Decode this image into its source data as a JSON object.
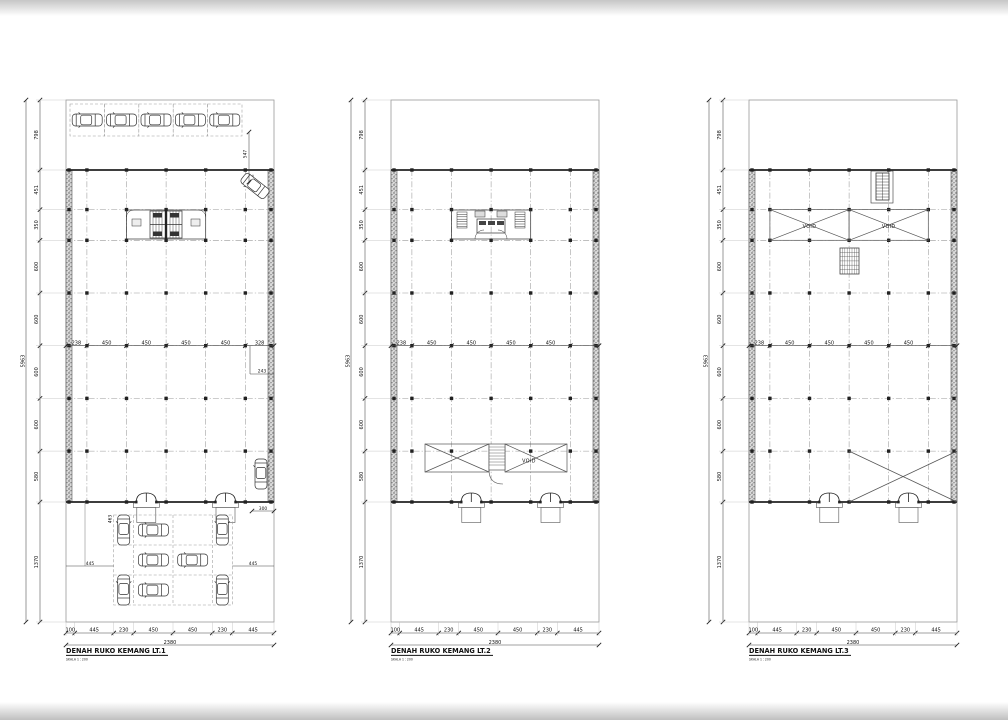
{
  "sheet": {
    "plans": [
      {
        "title": "DENAH RUKO KEMANG LT.1",
        "scale": "SKALA 1 : 200",
        "overall_height": "5963",
        "overall_width": "2380",
        "left_dims": [
          "798",
          "451",
          "350",
          "600",
          "600",
          "600",
          "600",
          "580",
          "1370"
        ],
        "mid_dims": [
          "238",
          "450",
          "450",
          "450",
          "450",
          "328"
        ],
        "bottom_dims": [
          "100",
          "445",
          "230",
          "450",
          "450",
          "230",
          "445"
        ],
        "annotations": {
          "car_turning": "547",
          "right_clear": "243",
          "entry_side": "463",
          "entry_step": "246",
          "park_left": "445",
          "park_right": "445",
          "car_bay": "300"
        }
      },
      {
        "title": "DENAH RUKO KEMANG LT.2",
        "scale": "SKALA 1 : 200",
        "overall_height": "5963",
        "overall_width": "2380",
        "left_dims": [
          "798",
          "451",
          "350",
          "600",
          "600",
          "600",
          "600",
          "580",
          "1370"
        ],
        "mid_dims": [
          "238",
          "450",
          "450",
          "450",
          "450"
        ],
        "bottom_dims": [
          "100",
          "445",
          "230",
          "450",
          "450",
          "230",
          "445"
        ],
        "annotations": {
          "void": "VOID"
        }
      },
      {
        "title": "DENAH RUKO KEMANG LT.3",
        "scale": "SKALA 1 : 200",
        "overall_height": "5963",
        "overall_width": "2380",
        "left_dims": [
          "798",
          "451",
          "350",
          "600",
          "600",
          "600",
          "600",
          "580",
          "1370"
        ],
        "mid_dims": [
          "238",
          "450",
          "450",
          "450",
          "450"
        ],
        "bottom_dims": [
          "100",
          "445",
          "230",
          "450",
          "450",
          "230",
          "445"
        ],
        "annotations": {
          "void_left": "VOID",
          "void_right": "VOID"
        }
      }
    ]
  }
}
